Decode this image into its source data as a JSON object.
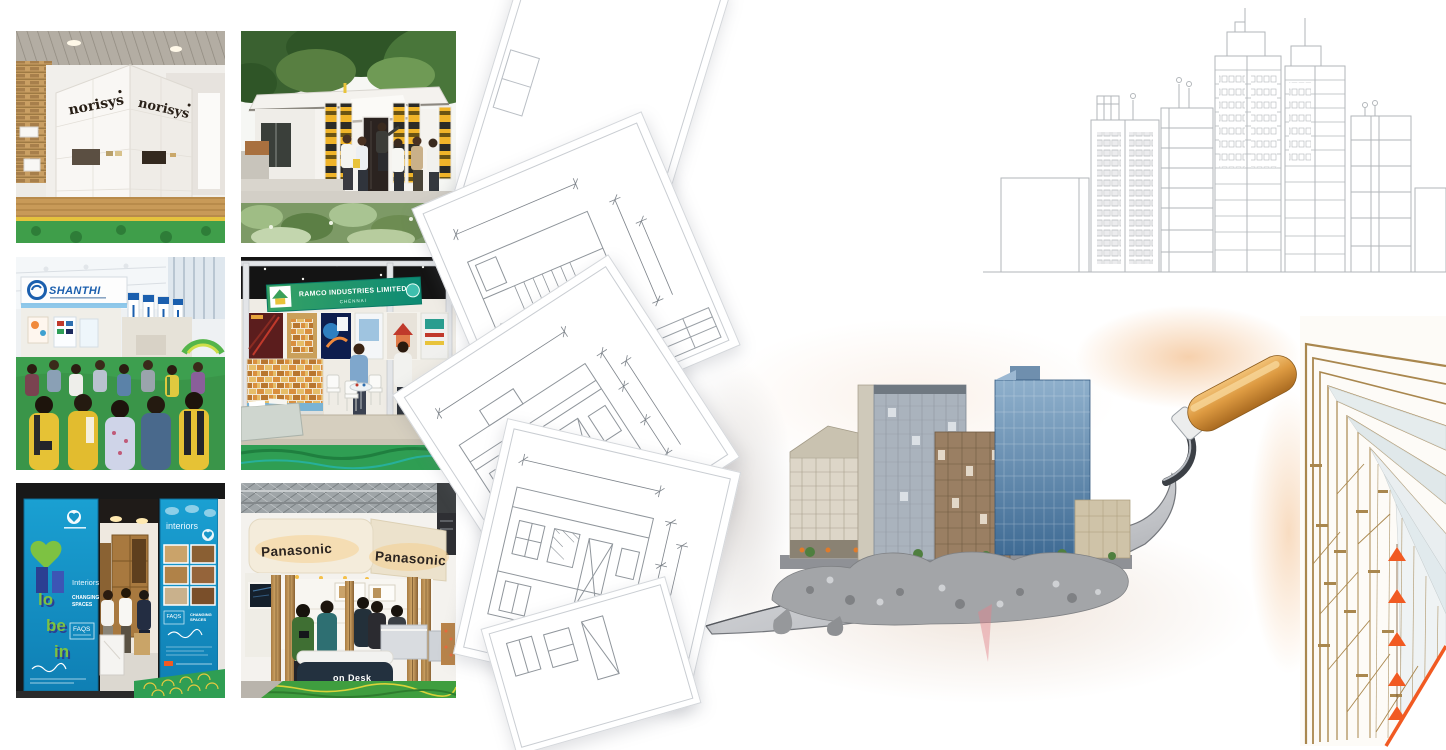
{
  "collage": {
    "norisys": {
      "brand": "norisys"
    },
    "shanthi": {
      "logo": "SHANTHI"
    },
    "ramco": {
      "title": "RAMCO INDUSTRIES LIMITED",
      "city": "CHENNAI"
    },
    "lobein": {
      "letter1": "lo",
      "letter2": "be",
      "letter3": "in",
      "interiors": "Interiors",
      "changing": "CHANGING",
      "spaces": "SPACES",
      "faqs": "FAQS",
      "interiors_right": "interiors"
    },
    "panasonic": {
      "sign": "Panasonic",
      "desk": "on Desk"
    }
  },
  "palette": {
    "carpet_green": "#3a9e4e",
    "banner_yellow": "#f0b429",
    "panel_blue": "#1796c8",
    "ramco_green_left": "#37a264",
    "ramco_green_right": "#0c8a74",
    "shanthi_blue": "#1b5fae",
    "fascia_cream": "#f2ead8",
    "sketch_gray": "#b2b6ba",
    "facade_brown": "#a9874e",
    "accent_orange": "#f15a22",
    "handle_wood": "#d9953f",
    "lobein_green": "#7dc242",
    "lobein_navy": "#2b3f92"
  }
}
